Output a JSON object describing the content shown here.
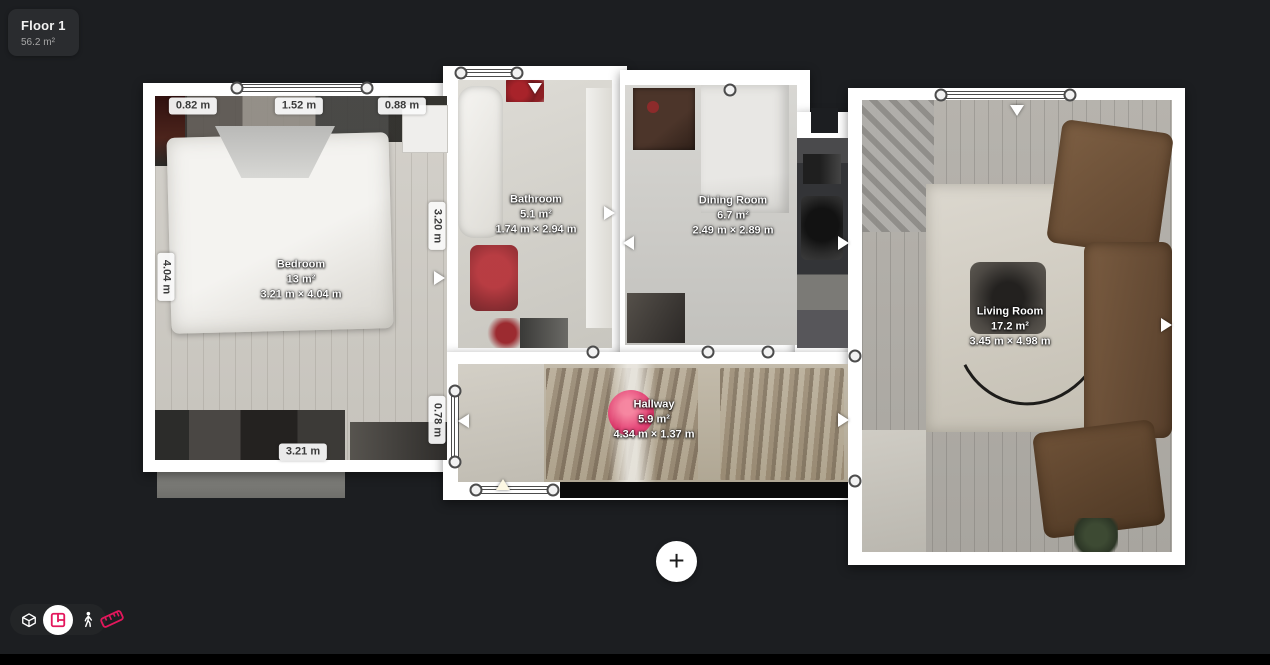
{
  "colors": {
    "background": "#1c1e21",
    "bottom_bar": "#000000",
    "accent_pink": "#e3175c",
    "wall_white": "#ffffff"
  },
  "floor_selector": {
    "name": "Floor 1",
    "area": "56.2 m²"
  },
  "rooms": [
    {
      "name": "Bedroom",
      "area": "13 m²",
      "dimensions": "3.21 m × 4.04 m"
    },
    {
      "name": "Bathroom",
      "area": "5.1 m²",
      "dimensions": "1.74 m × 2.94 m"
    },
    {
      "name": "Dining Room",
      "area": "6.7 m²",
      "dimensions": "2.49 m × 2.89 m"
    },
    {
      "name": "Hallway",
      "area": "5.9 m²",
      "dimensions": "4.34 m × 1.37 m"
    },
    {
      "name": "Living Room",
      "area": "17.2 m²",
      "dimensions": "3.45 m × 4.98 m"
    }
  ],
  "measurements": [
    {
      "id": "bedroom-top-left",
      "label": "0.82 m"
    },
    {
      "id": "bedroom-top-mid",
      "label": "1.52 m"
    },
    {
      "id": "bedroom-top-right",
      "label": "0.88 m"
    },
    {
      "id": "bedroom-left",
      "label": "4.04 m"
    },
    {
      "id": "bedroom-right",
      "label": "3.20 m"
    },
    {
      "id": "hallway-left",
      "label": "0.78 m"
    },
    {
      "id": "bedroom-bottom",
      "label": "3.21 m"
    }
  ],
  "toolbar": {
    "view_modes": [
      {
        "id": "dollhouse-view",
        "icon": "dollhouse-icon",
        "active": false
      },
      {
        "id": "floorplan-view",
        "icon": "floorplan-icon",
        "active": true
      },
      {
        "id": "walk-view",
        "icon": "walk-icon",
        "active": false
      }
    ],
    "measure_tool": {
      "icon": "measure-tape-icon"
    }
  },
  "add_button": {
    "label": "+"
  }
}
